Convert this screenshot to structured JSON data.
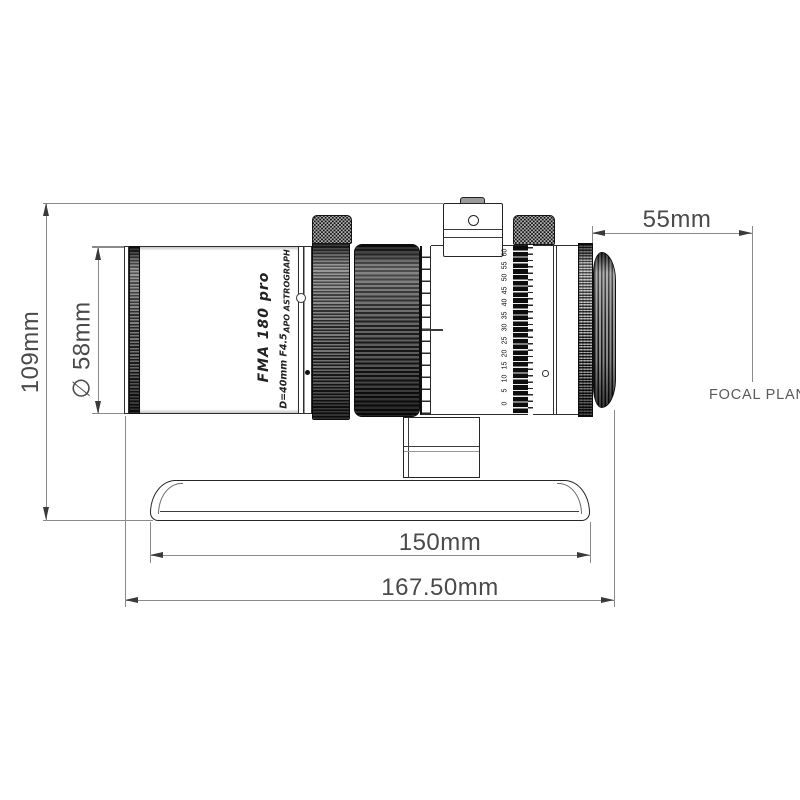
{
  "drawing_title": "telescope-side-view-technical-drawing",
  "dimensions": {
    "height": "109mm",
    "diameter": "∅ 58mm",
    "back_focus": "55mm",
    "dovetail_length": "150mm",
    "overall_length": "167.50mm",
    "focal_plane_label": "FOCAL PLANE"
  },
  "tube_markings": {
    "model": "FMA 180 pro",
    "aperture_ratio": "D=40mm F4.5",
    "type": "APO ASTROGRAPH"
  },
  "focuser_scale": {
    "numbers": [
      "60",
      "55",
      "50",
      "45",
      "40",
      "35",
      "30",
      "25",
      "20",
      "15",
      "10",
      "5",
      "0"
    ]
  },
  "colors": {
    "outline": "#2f2f2f",
    "dimension_line": "#8a8a8a",
    "background": "#ffffff"
  }
}
